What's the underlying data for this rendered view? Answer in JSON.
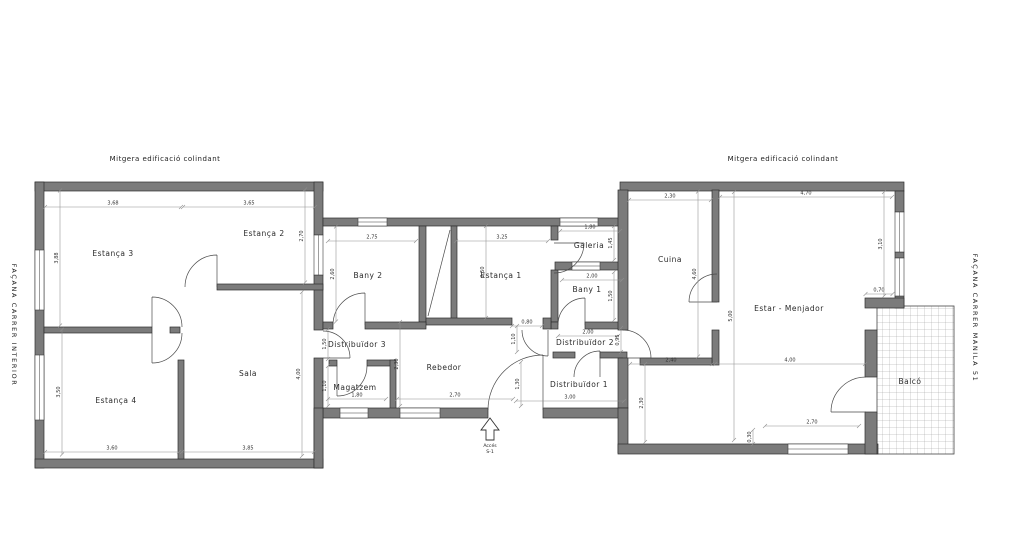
{
  "colors": {
    "background": "#ffffff",
    "wall_fill": "#7b7b7b",
    "wall_edge": "#2e2e2e",
    "dim_line": "#8f8f8f",
    "text": "#222222"
  },
  "annotations": {
    "mitgera_left": "Mitgera edificació colindant",
    "mitgera_right": "Mitgera edificació colindant",
    "facade_left": "FAÇANA CARRER INTERIOR",
    "facade_right": "FAÇANA CARRER MANILA 51",
    "access_label": "Accés",
    "access_sublabel": "S-1"
  },
  "rooms": [
    {
      "id": "estanca-3",
      "name": "Estança 3",
      "x": 113,
      "y": 256
    },
    {
      "id": "estanca-2",
      "name": "Estança 2",
      "x": 264,
      "y": 236
    },
    {
      "id": "estanca-4",
      "name": "Estança 4",
      "x": 116,
      "y": 403
    },
    {
      "id": "sala",
      "name": "Sala",
      "x": 248,
      "y": 376
    },
    {
      "id": "bany-2",
      "name": "Bany 2",
      "x": 368,
      "y": 278
    },
    {
      "id": "estanca-1",
      "name": "Estança 1",
      "x": 501,
      "y": 278
    },
    {
      "id": "galeria",
      "name": "Galeria",
      "x": 589,
      "y": 248
    },
    {
      "id": "bany-1",
      "name": "Bany 1",
      "x": 587,
      "y": 292
    },
    {
      "id": "distribuidor-3",
      "name": "Distribuïdor 3",
      "x": 357,
      "y": 347
    },
    {
      "id": "magatzem",
      "name": "Magatzem",
      "x": 355,
      "y": 390
    },
    {
      "id": "rebedor",
      "name": "Rebedor",
      "x": 444,
      "y": 370
    },
    {
      "id": "distribuidor-2",
      "name": "Distribuïdor 2",
      "x": 585,
      "y": 345
    },
    {
      "id": "distribuidor-1",
      "name": "Distribuïdor 1",
      "x": 579,
      "y": 387
    },
    {
      "id": "cuina",
      "name": "Cuina",
      "x": 670,
      "y": 262
    },
    {
      "id": "estar-menjador",
      "name": "Estar - Menjador",
      "x": 789,
      "y": 311
    },
    {
      "id": "balco",
      "name": "Balcó",
      "x": 910,
      "y": 384
    }
  ],
  "dimensions": [
    {
      "v": "3,68",
      "x": 113,
      "y": 207,
      "r": 0,
      "l": 136
    },
    {
      "v": "3,65",
      "x": 249,
      "y": 207,
      "r": 0,
      "l": 132
    },
    {
      "v": "2,75",
      "x": 372,
      "y": 241,
      "r": 0,
      "l": 88
    },
    {
      "v": "3,25",
      "x": 502,
      "y": 241,
      "r": 0,
      "l": 92
    },
    {
      "v": "1,80",
      "x": 590,
      "y": 231,
      "r": 0,
      "l": 60
    },
    {
      "v": "2,30",
      "x": 670,
      "y": 200,
      "r": 0,
      "l": 82
    },
    {
      "v": "4,70",
      "x": 806,
      "y": 197,
      "r": 0,
      "l": 172
    },
    {
      "v": "2,00",
      "x": 592,
      "y": 280,
      "r": 0,
      "l": 60
    },
    {
      "v": "0,80",
      "x": 527,
      "y": 326,
      "r": 0,
      "l": 30
    },
    {
      "v": "2,00",
      "x": 588,
      "y": 336,
      "r": 0,
      "l": 60
    },
    {
      "v": "1,80",
      "x": 357,
      "y": 399,
      "r": 0,
      "l": 58
    },
    {
      "v": "2,70",
      "x": 455,
      "y": 399,
      "r": 0,
      "l": 116
    },
    {
      "v": "3,00",
      "x": 570,
      "y": 401,
      "r": 0,
      "l": 108
    },
    {
      "v": "2,40",
      "x": 671,
      "y": 364,
      "r": 0,
      "l": 82
    },
    {
      "v": "4,00",
      "x": 790,
      "y": 364,
      "r": 0,
      "l": 150
    },
    {
      "v": "2,70",
      "x": 812,
      "y": 426,
      "r": 0,
      "l": 94
    },
    {
      "v": "0,70",
      "x": 879,
      "y": 294,
      "r": 0,
      "l": 27
    },
    {
      "v": "3,60",
      "x": 112,
      "y": 452,
      "r": 0,
      "l": 134
    },
    {
      "v": "3,85",
      "x": 248,
      "y": 452,
      "r": 0,
      "l": 132
    },
    {
      "v": "3,88",
      "x": 60,
      "y": 258,
      "r": 1,
      "l": 135
    },
    {
      "v": "2,70",
      "x": 305,
      "y": 236,
      "r": 1,
      "l": 93
    },
    {
      "v": "2,60",
      "x": 336,
      "y": 274,
      "r": 1,
      "l": 95
    },
    {
      "v": "2,50",
      "x": 486,
      "y": 272,
      "r": 1,
      "l": 92
    },
    {
      "v": "3,50",
      "x": 62,
      "y": 392,
      "r": 1,
      "l": 125
    },
    {
      "v": "4,00",
      "x": 302,
      "y": 374,
      "r": 1,
      "l": 164
    },
    {
      "v": "1,45",
      "x": 614,
      "y": 243,
      "r": 1,
      "l": 34
    },
    {
      "v": "1,50",
      "x": 614,
      "y": 296,
      "r": 1,
      "l": 48
    },
    {
      "v": "1,10",
      "x": 517,
      "y": 339,
      "r": 1,
      "l": 26
    },
    {
      "v": "0,95",
      "x": 621,
      "y": 340,
      "r": 1,
      "l": 24
    },
    {
      "v": "1,50",
      "x": 328,
      "y": 344,
      "r": 1,
      "l": 30
    },
    {
      "v": "1,10",
      "x": 328,
      "y": 386,
      "r": 1,
      "l": 40
    },
    {
      "v": "2,30",
      "x": 400,
      "y": 364,
      "r": 1,
      "l": 84
    },
    {
      "v": "1,30",
      "x": 521,
      "y": 384,
      "r": 1,
      "l": 44
    },
    {
      "v": "2,30",
      "x": 645,
      "y": 403,
      "r": 1,
      "l": 78
    },
    {
      "v": "4,60",
      "x": 698,
      "y": 274,
      "r": 1,
      "l": 165
    },
    {
      "v": "3,10",
      "x": 884,
      "y": 244,
      "r": 1,
      "l": 104
    },
    {
      "v": "5,00",
      "x": 734,
      "y": 316,
      "r": 1,
      "l": 248
    },
    {
      "v": "0,30",
      "x": 753,
      "y": 437,
      "r": 1,
      "l": 14
    }
  ]
}
